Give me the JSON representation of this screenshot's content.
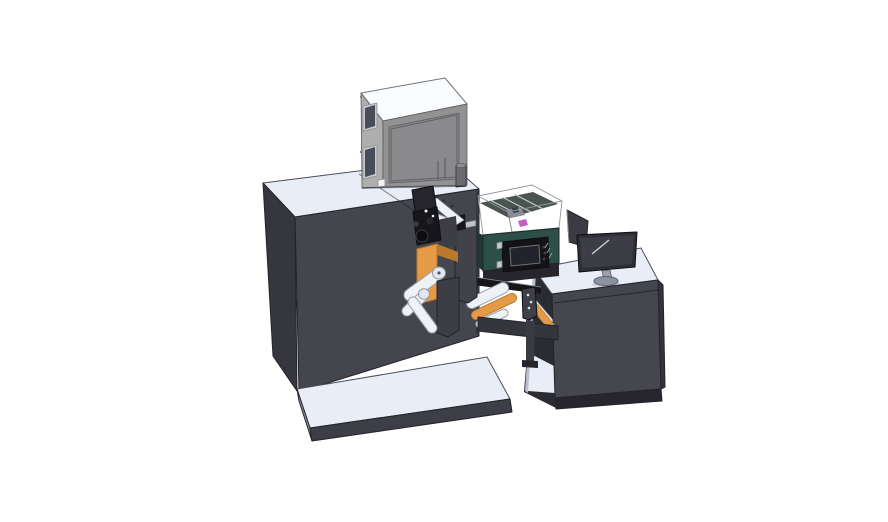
{
  "scene": {
    "background": "#ffffff",
    "description": "isometric-cad-render-label-printing-machine-with-operator-desk"
  },
  "palette": {
    "topLight": "#e9edf8",
    "machineFront": "#45454d",
    "machineSide": "#36363d",
    "machineEdge": "#26262c",
    "platformFront": "#3e3e46",
    "platformSide": "#8f95a4",
    "boxTop": "#fafbfd",
    "boxLeft": "#aeaeac",
    "boxFront": "#929292",
    "boxPanel": "#8a8a8c",
    "winFrame": "#c6cacc",
    "winGlass": "#474c58",
    "cylBody": "#6b6b70",
    "cylTop": "#8e8e92",
    "whiteSq": "#f2f3f5",
    "rollerFill": "#eef1f6",
    "rollerEdge": "#9aa2ad",
    "rollerCap": "#e2e6ed",
    "capDot": "#55595f",
    "orange": "#e49a46",
    "orangeDark": "#b97a2b",
    "ink": "#17171b",
    "inkDeep": "#0e0e12",
    "clusterTop": "#26262c",
    "darkPlate": "#3d3d45",
    "mountPlate": "#42424b",
    "rail": "#bdc2cb",
    "greenFace": "#2d5046",
    "greenSide": "#1e3a31",
    "underStrip": "#26262c",
    "hmiBody": "#141417",
    "hmiScreen": "#23232b",
    "hmiRing": "#6d7270",
    "hmiButton": "#3c3f3e",
    "clearFill": "rgba(223,228,238,0.45)",
    "interiorFloor": "#4a554f",
    "magenta": "#c45fc4",
    "internalGray": "#8a8f97",
    "internalDark": "#3a3a40",
    "deskFront": "#46464e",
    "deskSide": "#33333a",
    "deskBottom": "#26262c",
    "deskInterior": "#2b2b32",
    "lightStrip": "#b9bfcc",
    "monitorBezel": "#2e2e35",
    "monitorScreen": "#3d3d46",
    "monitorHighlight": "#d0d5dc",
    "standGray": "#99a1ad",
    "baseGray": "#8b93a0",
    "panelBack": "#3b3b43",
    "beam": "#35353c",
    "leg": "#3a3a41",
    "bracket": "#3f3f47",
    "bracketDot": "#dfe3e8",
    "screw": "#2e2e34",
    "hinge": "#7f7f7d"
  },
  "parts": [
    {
      "id": "main-cabinet",
      "label": "printer-main-cabinet"
    },
    {
      "id": "base-platform",
      "label": "machine-base-platform"
    },
    {
      "id": "top-box",
      "label": "top-filter-box"
    },
    {
      "id": "printhead",
      "label": "print-head-assembly"
    },
    {
      "id": "unwinder",
      "label": "unwind-roller-assembly"
    },
    {
      "id": "web-rollers",
      "label": "label-web-rollers"
    },
    {
      "id": "control-module",
      "label": "green-control-module-with-hmi"
    },
    {
      "id": "clear-cover",
      "label": "transparent-safety-cover"
    },
    {
      "id": "support-beam",
      "label": "web-support-beam"
    },
    {
      "id": "sensor-bracket",
      "label": "sensor-bracket"
    },
    {
      "id": "desk",
      "label": "operator-desk"
    },
    {
      "id": "monitor",
      "label": "desk-monitor"
    },
    {
      "id": "rear-panel",
      "label": "rear-display-panel"
    }
  ]
}
